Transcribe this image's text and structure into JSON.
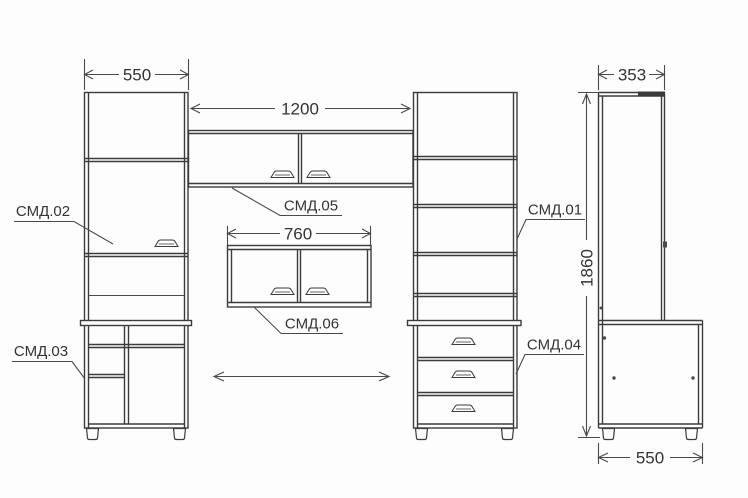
{
  "labels": {
    "smd01": "СМД.01",
    "smd02": "СМД.02",
    "smd03": "СМД.03",
    "smd04": "СМД.04",
    "smd05": "СМД.05",
    "smd06": "СМД.06"
  },
  "dimensions": {
    "left_cabinet_width": "550",
    "wall_cabinet_width": "1200",
    "desk_shelf_width": "760",
    "side_top_depth": "353",
    "total_height": "1860",
    "side_bottom_depth": "550"
  },
  "colors": {
    "line": "#3c3c3c",
    "dimension_line": "#4a4a4a",
    "text": "#333333",
    "background": "#fdfdfd"
  }
}
